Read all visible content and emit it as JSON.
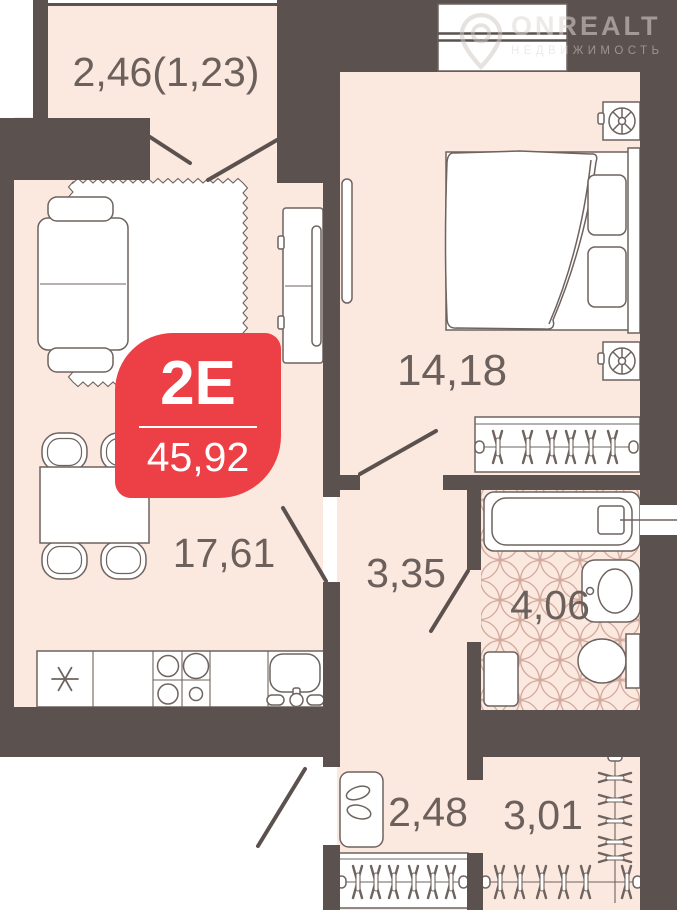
{
  "apartment": {
    "type_label": "2Е",
    "total_area": "45,92"
  },
  "rooms": [
    {
      "id": "balcony",
      "area_label": "2,46(1,23)"
    },
    {
      "id": "bedroom",
      "area_label": "14,18"
    },
    {
      "id": "living-kitchen",
      "area_label": "17,61"
    },
    {
      "id": "hallway",
      "area_label": "3,35"
    },
    {
      "id": "bathroom",
      "area_label": "4,06"
    },
    {
      "id": "entry-hall",
      "area_label": "2,48"
    },
    {
      "id": "wardrobe",
      "area_label": "3,01"
    }
  ],
  "watermark": {
    "brand": "ONREALT",
    "tagline": "НЕДВИЖИМОСТЬ"
  },
  "colors": {
    "wall": "#5b514f",
    "floor": "#fbe8df",
    "accent_red": "#ec4046",
    "furniture_line": "#6e635f",
    "label_text": "#6b605b",
    "tile_line": "#c89a8b"
  }
}
